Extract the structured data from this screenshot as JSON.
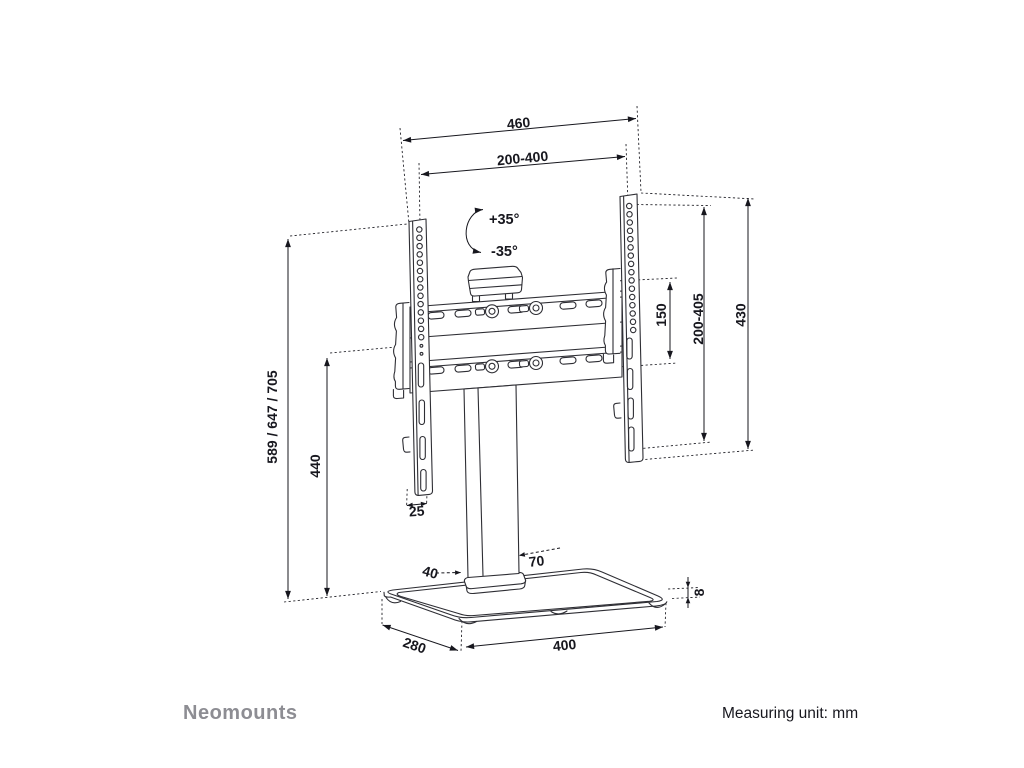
{
  "brand": "Neomounts",
  "footer_note": "Measuring unit: mm",
  "dimensions": {
    "overall_width": "460",
    "vesa_width_range": "200-400",
    "swivel_right": "+35°",
    "swivel_left": "-35°",
    "hook_spacing": "150",
    "vesa_height_range": "200-405",
    "bracket_length": "430",
    "overall_height": "589 / 647 / 705",
    "column_height": "440",
    "bracket_width": "25",
    "column_depth": "40",
    "column_width": "70",
    "base_depth": "280",
    "base_width": "400",
    "base_thickness": "8"
  },
  "colors": {
    "line": "#2e2e34",
    "dim": "#17171e",
    "brand": "#8d8d93",
    "bg": "#ffffff"
  }
}
